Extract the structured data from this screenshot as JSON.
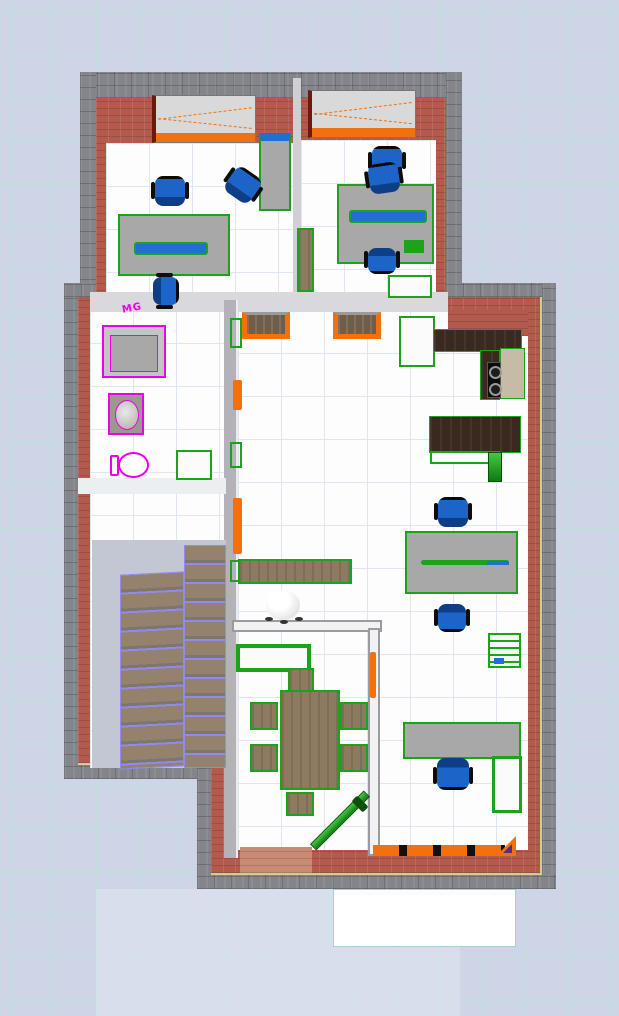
{
  "labels": {
    "shower_brand": "MG"
  },
  "colors": {
    "bg": "#cdd5e7",
    "grid": "#bfdede",
    "stone": "#84848b",
    "cream": "#d8c98e",
    "brick": "#b35a4c",
    "brickLight": "#c98a74",
    "floor": "#fdfdfe",
    "floorLine": "#dfe6f0",
    "wallGray": "#cfcfd4",
    "green": "#1ca21c",
    "deskGray": "#a8a8a8",
    "blue": "#1c64c8",
    "blueDark": "#0e3f86",
    "strip": "#1f6fd4",
    "orange": "#f2700e",
    "magenta": "#ea00ea",
    "wood": "#8d7a61",
    "woodDark": "#6f5d49",
    "counter": "#39291f",
    "beige": "#c6bba6",
    "violet": "#8f8af2",
    "patioEdge": "#a4d2ca"
  },
  "legend": {
    "selection_outline": "green = selected furniture",
    "door_window_accent": "orange = doors and windows",
    "plumbing_accent": "magenta = bathroom fixtures",
    "stairs_accent": "violet = stair treads"
  }
}
